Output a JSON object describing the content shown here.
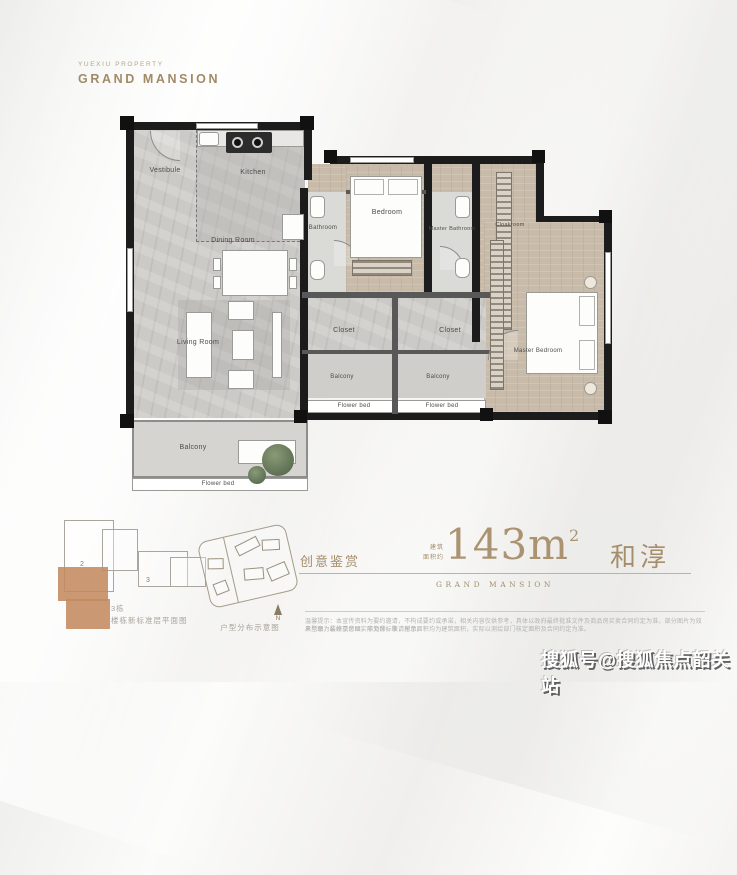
{
  "brand": {
    "subtitle": "YUEXIU PROPERTY",
    "title": "GRAND MANSION"
  },
  "plan": {
    "rooms": [
      {
        "name": "vestibule",
        "label": "Vestibule"
      },
      {
        "name": "kitchen",
        "label": "Kitchen"
      },
      {
        "name": "dining-room",
        "label": "Dining Room"
      },
      {
        "name": "living-room",
        "label": "Living Room"
      },
      {
        "name": "bathroom",
        "label": "Bathroom"
      },
      {
        "name": "bedroom",
        "label": "Bedroom"
      },
      {
        "name": "master-bathroom",
        "label": "Master Bathroom"
      },
      {
        "name": "cloakroom",
        "label": "Cloakroom"
      },
      {
        "name": "master-bedroom",
        "label": "Master Bedroom"
      },
      {
        "name": "closet-left",
        "label": "Closet"
      },
      {
        "name": "closet-right",
        "label": "Closet"
      },
      {
        "name": "balcony-small-left",
        "label": "Balcony"
      },
      {
        "name": "balcony-small-right",
        "label": "Balcony"
      },
      {
        "name": "balcony-main",
        "label": "Balcony"
      },
      {
        "name": "flowerbed-main",
        "label": "Flower bed"
      },
      {
        "name": "flowerbed-left",
        "label": "Flower bed"
      },
      {
        "name": "flowerbed-right",
        "label": "Flower bed"
      }
    ]
  },
  "keyplan": {
    "unit_2": "2",
    "unit_3": "3",
    "caption_line1": "3栋",
    "caption_line2": "楼栋新标准层平面图"
  },
  "siteplan": {
    "caption": "户型分布示意图",
    "compass_label": "N"
  },
  "info": {
    "left_title": "创意鉴赏",
    "area_prefix_top": "建筑",
    "area_prefix_bottom": "面积约",
    "area_value": "143m",
    "area_sup": "2",
    "series_name": "GRAND MANSION",
    "unit_name": "和淳",
    "disclaimer_line1": "温馨提示：本宣传资料为要约邀请，不构成要约或承诺，相关内容仅供参考，具体以政府最终批准文件及商品房买卖合同约定为准，部分图片为效果示意，最终交付以实际为准，敬请留意。",
    "disclaimer_line2": "户型图为装修示意图，非交付标准，所示面积均为建筑面积，实际以测绘部门核定面积及合同约定为准。"
  },
  "watermark": "搜狐号@搜狐焦点韶关站",
  "colors": {
    "gold": "#a68e6d",
    "wall_black": "#1c1c1c",
    "wood_floor": "#c8bba9",
    "marble_floor": "#cbcac6",
    "keyplan_tan": "#c38a5f",
    "plant_green": "#5f7154"
  }
}
